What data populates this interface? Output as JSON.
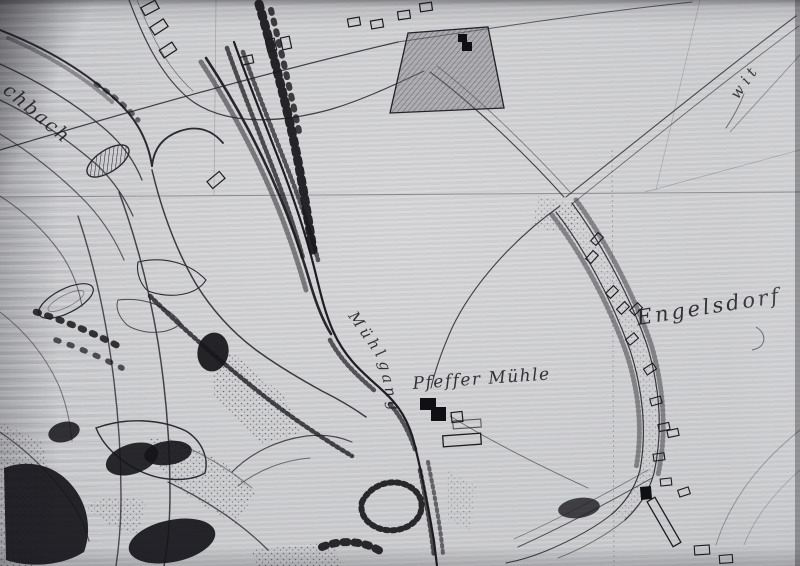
{
  "map": {
    "type": "photograph of a historical hand-drawn manuscript map",
    "colors": {
      "paper": "#cfd0d3",
      "ink": "#1d1d22",
      "faint_grid": "#3f3f49",
      "woodland": "#15151a"
    },
    "labels": {
      "stream_name_partial": "chbach",
      "millrace_word_upper": "Mühl",
      "millrace_word_lower": "gang",
      "mill_name": "Pfeffer Mühle",
      "village_name": "Engelsdorf",
      "edge_fragment": "wit"
    },
    "features": [
      "river floodplain with islands and sandbars",
      "tree-lined mill stream",
      "water mill buildings (filled black)",
      "village street with houses on both sides",
      "hatched field plot",
      "faint survey grid lines",
      "dark woodland clusters"
    ]
  }
}
